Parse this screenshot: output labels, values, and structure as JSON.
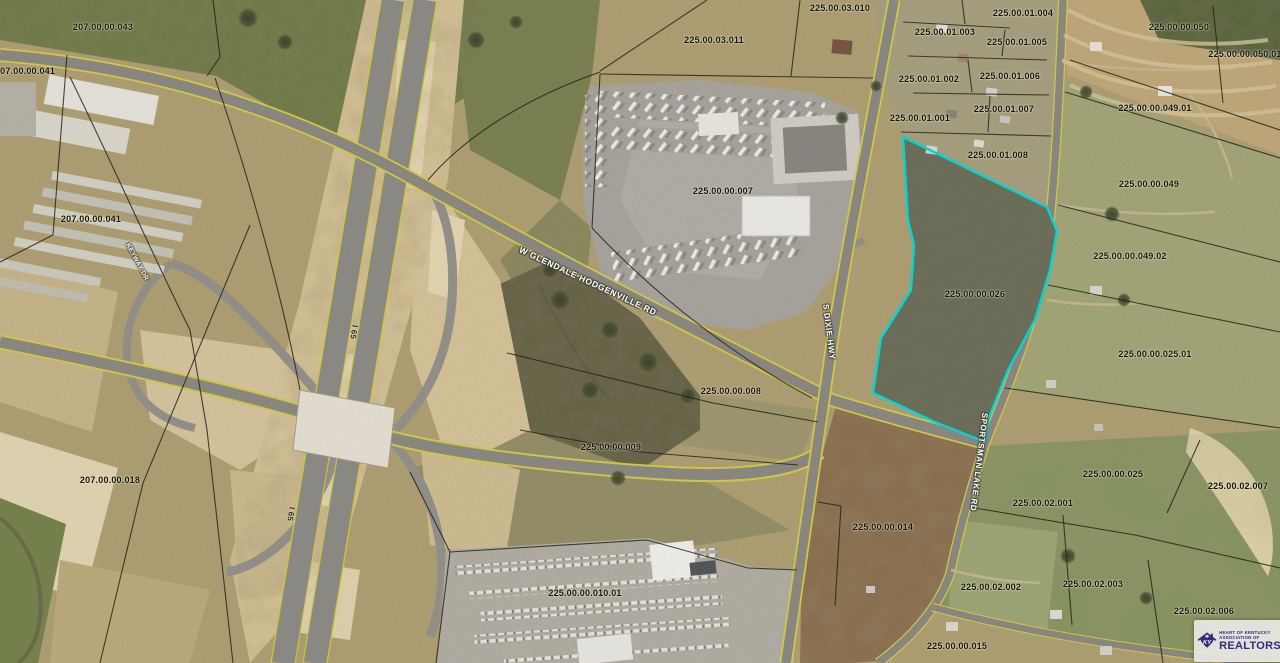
{
  "parcels": [
    "207.00.00.043",
    "207.00.00.041",
    "207.00.00.041",
    "207.00.00.018",
    "225.00.03.010",
    "225.00.03.011",
    "225.00.00.007",
    "225.00.00.008",
    "225.00.00.009",
    "225.00.00.010.01",
    "225.00.00.014",
    "225.00.00.015",
    "225.00.00.026",
    "225.00.01.001",
    "225.00.01.002",
    "225.00.01.003",
    "225.00.01.004",
    "225.00.01.005",
    "225.00.01.006",
    "225.00.01.007",
    "225.00.01.008",
    "225.00.00.050",
    "225.00.00.050.01",
    "225.00.00.049.01",
    "225.00.00.049",
    "225.00.00.049.02",
    "225.00.00.025.01",
    "225.00.00.025",
    "225.00.02.007",
    "225.00.02.001",
    "225.00.02.002",
    "225.00.02.003",
    "225.00.02.006"
  ],
  "roads": {
    "glendale_hodgenville": "W GLENDALE HODGENVILLE RD",
    "dixie": "S DIXIE HWY",
    "sportsman": "SPORTSMAN LAKE RD",
    "interstate": "I 65",
    "frontage": "KEYWAY DR"
  },
  "highlighted_parcel": {
    "id": "225.00.00.026",
    "outline_color": "#00E0DD"
  },
  "logo": {
    "state_abbr": "KY",
    "org_line1": "HEART OF KENTUCKY",
    "org_line2": "ASSOCIATION OF",
    "org_name": "REALTORS",
    "registered": "®",
    "brand_color": "#312A7D"
  }
}
